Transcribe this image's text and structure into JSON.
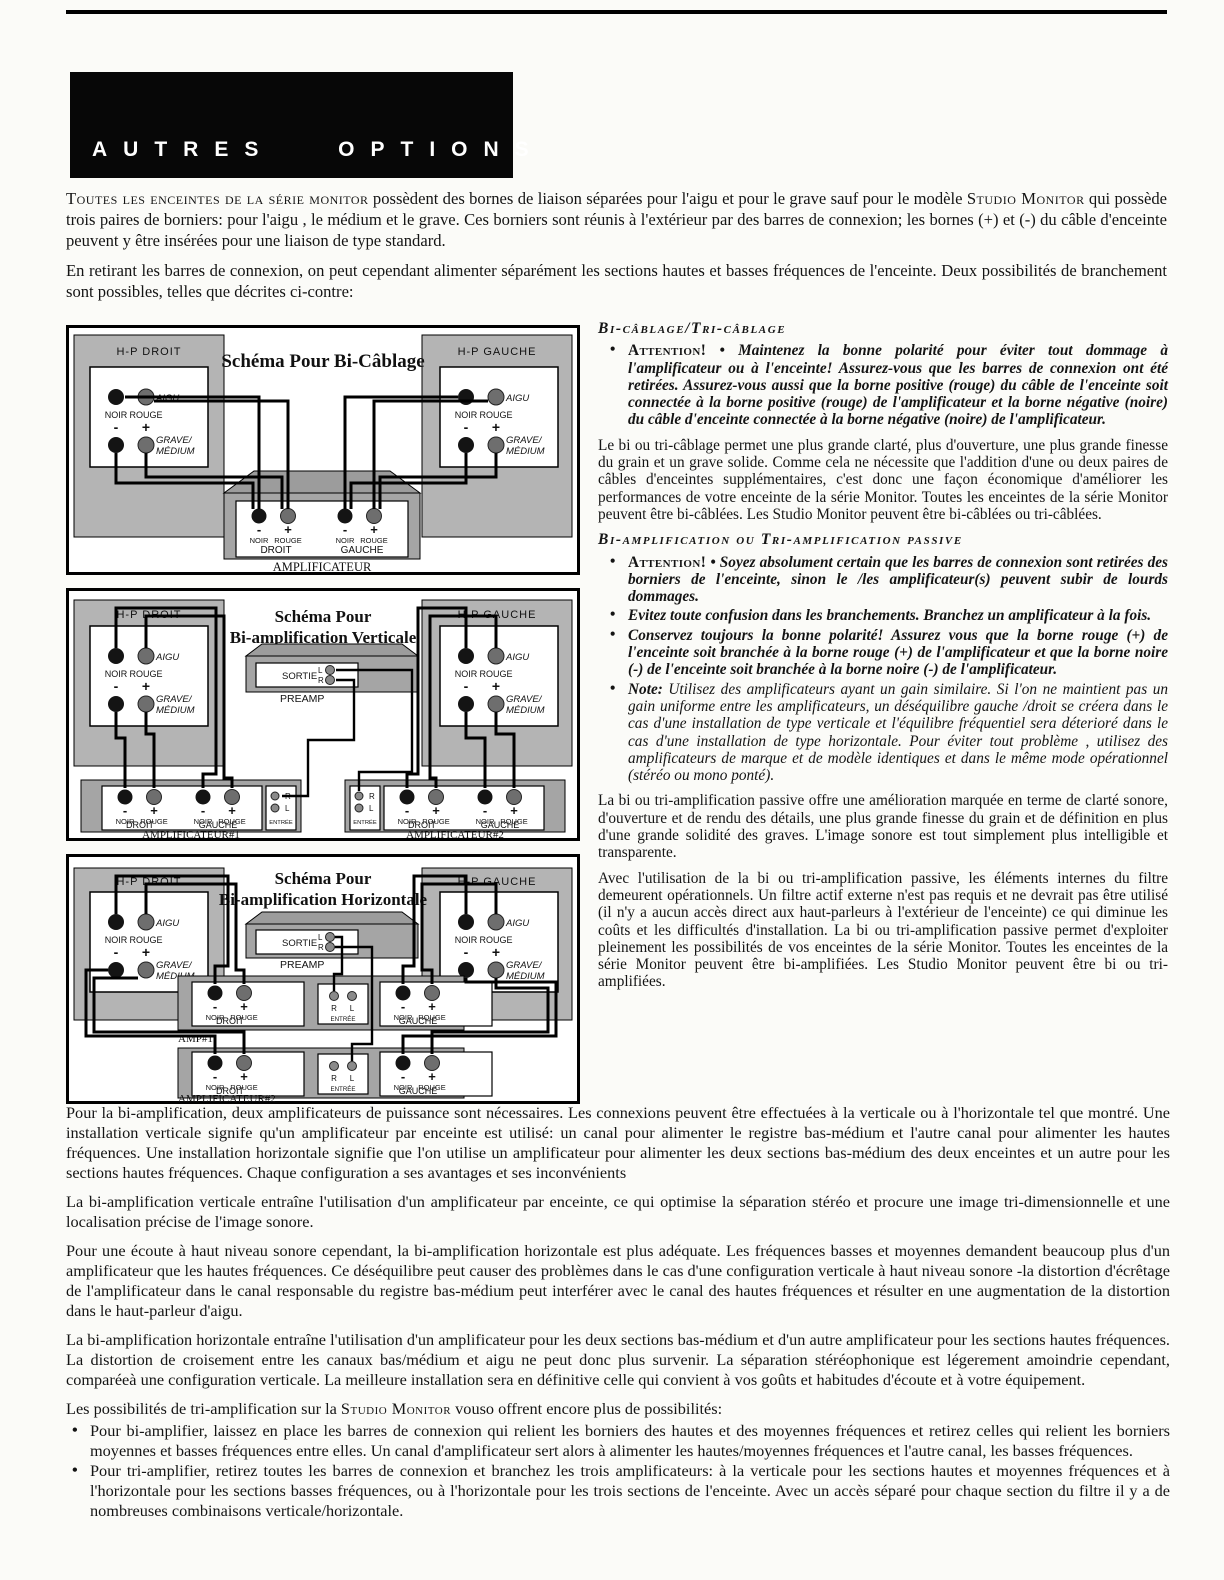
{
  "header": {
    "title": "AUTRES OPTIONS"
  },
  "glyphs": {
    "bullet": "•"
  },
  "colors": {
    "banner_black": "#070707",
    "panel_gray": "#b4b4b4",
    "amp_gray": "#a5a5a5",
    "terminal_noir": "#141414",
    "terminal_rouge": "#6e6e6e"
  },
  "intro": {
    "p1_sc1": "Toutes les enceintes de la série monitor",
    "p1_t1": " possèdent des bornes de liaison séparées pour l'aigu et pour le grave sauf pour le modèle ",
    "p1_sc2": "Studio Monitor",
    "p1_t2": " qui possède trois paires de borniers: pour l'aigu , le médium et le grave. Ces borniers sont réunis à l'extérieur par des barres de connexion; les bornes (+) et (-) du câble d'enceinte peuvent y être insérées pour une liaison de type standard.",
    "p2": "En retirant les barres de connexion, on peut cependant alimenter séparément les sections hautes et basses fréquences de l'enceinte. Deux possibilités de branchement sont possibles, telles que décrites ci-contre:"
  },
  "diagrams": {
    "labels": {
      "hp_droit": "H-P DROIT",
      "hp_gauche": "H-P GAUCHE",
      "aigu": "AIGU",
      "grave": "GRAVE/",
      "medium": "MÉDIUM",
      "noir": "NOIR",
      "rouge": "ROUGE",
      "minus": "-",
      "plus": "+",
      "droit": "DROIT",
      "gauche": "GAUCHE",
      "entree": "ENTRÉE",
      "sortie": "SORTIE",
      "preamp": "PREAMP",
      "l": "L",
      "r": "R",
      "amplificateur": "AMPLIFICATEUR",
      "amplificateur1": "AMPLIFICATEUR#1",
      "amplificateur2": "AMPLIFICATEUR#2",
      "amp1_short": "AMP#1"
    },
    "d1": {
      "title": "Schéma Pour Bi-Câblage"
    },
    "d2": {
      "title_line1": "Schéma Pour",
      "title_line2": "Bi-amplification Verticale"
    },
    "d3": {
      "title_line1": "Schéma Pour",
      "title_line2": "Bi-amplification Horizontale"
    }
  },
  "right_col": {
    "s1_heading": "Bi-câblage/Tri-câblage",
    "s1_b1_attention": "Attention!",
    "s1_b1_sep": " • ",
    "s1_b1_text": "Maintenez la bonne polarité pour éviter tout dommage à l'amplificateur ou à l'enceinte! Assurez-vous que les barres de connexion ont été retirées. Assurez-vous aussi que la borne positive (rouge) du câble de l'enceinte soit connectée à la borne positive (rouge) de l'amplificateur et la borne négative (noire) du câble d'enceinte connectée à la borne négative (noire) de l'amplificateur.",
    "s1_p1": "Le bi ou tri-câblage permet une plus grande clarté, plus d'ouverture, une plus grande finesse du grain et un grave solide. Comme cela ne nécessite que l'addition d'une ou deux paires de câbles d'enceintes supplémentaires, c'est donc une façon économique d'améliorer les performances de votre enceinte de la série Monitor. Toutes les enceintes de la série Monitor peuvent être bi-câblées. Les Studio Monitor peuvent être bi-câblées ou tri-câblées.",
    "s2_heading": "Bi-amplification ou Tri-amplification passive",
    "s2_b1_attention": "Attention!",
    "s2_b1_sep": " • ",
    "s2_b1_text": "Soyez absolument certain que les barres de connexion sont retirées des borniers de l'enceinte, sinon le /les amplificateur(s) peuvent subir de lourds dommages.",
    "s2_b2_text": "Evitez toute confusion dans les branchements. Branchez un amplificateur à la fois.",
    "s2_b3_text": "Conservez toujours la bonne polarité! Assurez vous que la borne rouge (+) de l'enceinte soit branchée à la borne rouge (+) de l'amplificateur et que la borne noire (-) de l'enceinte soit branchée à la borne noire (-) de l'amplificateur.",
    "s2_b4_label": "Note:",
    "s2_b4_text": " Utilisez des amplificateurs ayant un gain similaire. Si l'on ne maintient pas un gain uniforme entre les amplificateurs, un déséquilibre gauche /droit se créera dans le cas d'une installation de type verticale et l'équilibre fréquentiel sera déterioré dans le cas d'une installation de type horizontale. Pour éviter tout problème , utilisez des amplificateurs de marque et de modèle identiques et dans le même mode opérationnel (stéréo ou mono ponté).",
    "s2_p1": "La bi ou tri-amplification passive offre une amélioration marquée en terme de clarté sonore, d'ouverture et de rendu des détails, une plus grande finesse du grain et de définition en plus d'une grande solidité des graves. L'image sonore est tout simplement plus intelligible et transparente.",
    "s2_p2": "Avec l'utilisation de la bi ou tri-amplification passive, les éléments internes du filtre demeurent opérationnels. Un filtre actif externe n'est pas requis et ne devrait pas être utilisé (il n'y a aucun accès direct aux haut-parleurs à l'extérieur de l'enceinte) ce qui diminue les coûts et les difficultés d'installation. La bi ou tri-amplification passive permet d'exploiter pleinement les possibilités de vos enceintes de la série Monitor. Toutes les enceintes de la série Monitor peuvent être bi-amplifiées. Les Studio Monitor peuvent être bi ou tri-amplifiées."
  },
  "bottom": {
    "p1": "Pour la bi-amplification, deux amplificateurs de puissance sont nécessaires. Les connexions peuvent être effectuées à la verticale ou à l'horizontale tel que montré. Une installation verticale signife qu'un amplificateur par enceinte est utilisé: un canal pour alimenter le registre bas-médium et l'autre canal pour alimenter les hautes fréquences. Une installation horizontale signifie que l'on utilise un amplificateur pour alimenter les deux sections bas-médium des deux enceintes et un autre pour les sections hautes fréquences. Chaque configuration a ses avantages et ses inconvénients",
    "p2": "La bi-amplification verticale entraîne l'utilisation d'un amplificateur par enceinte, ce qui optimise la séparation stéréo et procure une image tri-dimensionnelle et une localisation précise de l'image sonore.",
    "p3": "Pour une écoute à haut niveau sonore cependant, la bi-amplification horizontale est plus adéquate. Les fréquences basses et moyennes demandent beaucoup plus d'un amplificateur que les hautes fréquences. Ce déséquilibre peut causer des problèmes dans le cas d'une configuration verticale à haut niveau sonore -la distortion d'écrêtage de l'amplificateur dans le canal responsable du registre bas-médium peut interférer avec le canal des hautes fréquences et résulter en une augmentation de la distortion dans le haut-parleur d'aigu.",
    "p4": "La bi-amplification horizontale  entraîne l'utilisation d'un amplificateur pour les deux sections bas-médium et d'un autre amplificateur pour les sections hautes fréquences. La distortion de croisement entre les canaux bas/médium et aigu ne peut donc plus survenir. La séparation stéréophonique est légerement amoindrie cependant, comparéeà une configuration verticale. La meilleure installation sera en définitive celle qui convient à vos goûts et habitudes d'écoute et à votre équipement.",
    "p5_t1": "Les possibilités de tri-amplification sur la ",
    "p5_sc": "Studio Monitor",
    "p5_t2": " vouso offrent encore plus de possibilités:",
    "b1": "Pour bi-amplifier, laissez en place les barres de connexion qui relient les borniers des hautes et des moyennes fréquences et retirez celles qui relient les borniers moyennes et basses fréquences entre elles. Un canal d'amplificateur sert alors à alimenter les hautes/moyennes fréquences et l'autre canal, les basses fréquences.",
    "b2": "Pour tri-amplifier, retirez toutes les barres de connexion et branchez les trois amplificateurs: à la verticale pour les sections hautes et moyennes fréquences et à l'horizontale pour les sections basses fréquences, ou à l'horizontale pour les trois sections de l'enceinte. Avec un accès séparé pour chaque section du filtre il y a de nombreuses combinaisons verticale/horizontale."
  }
}
